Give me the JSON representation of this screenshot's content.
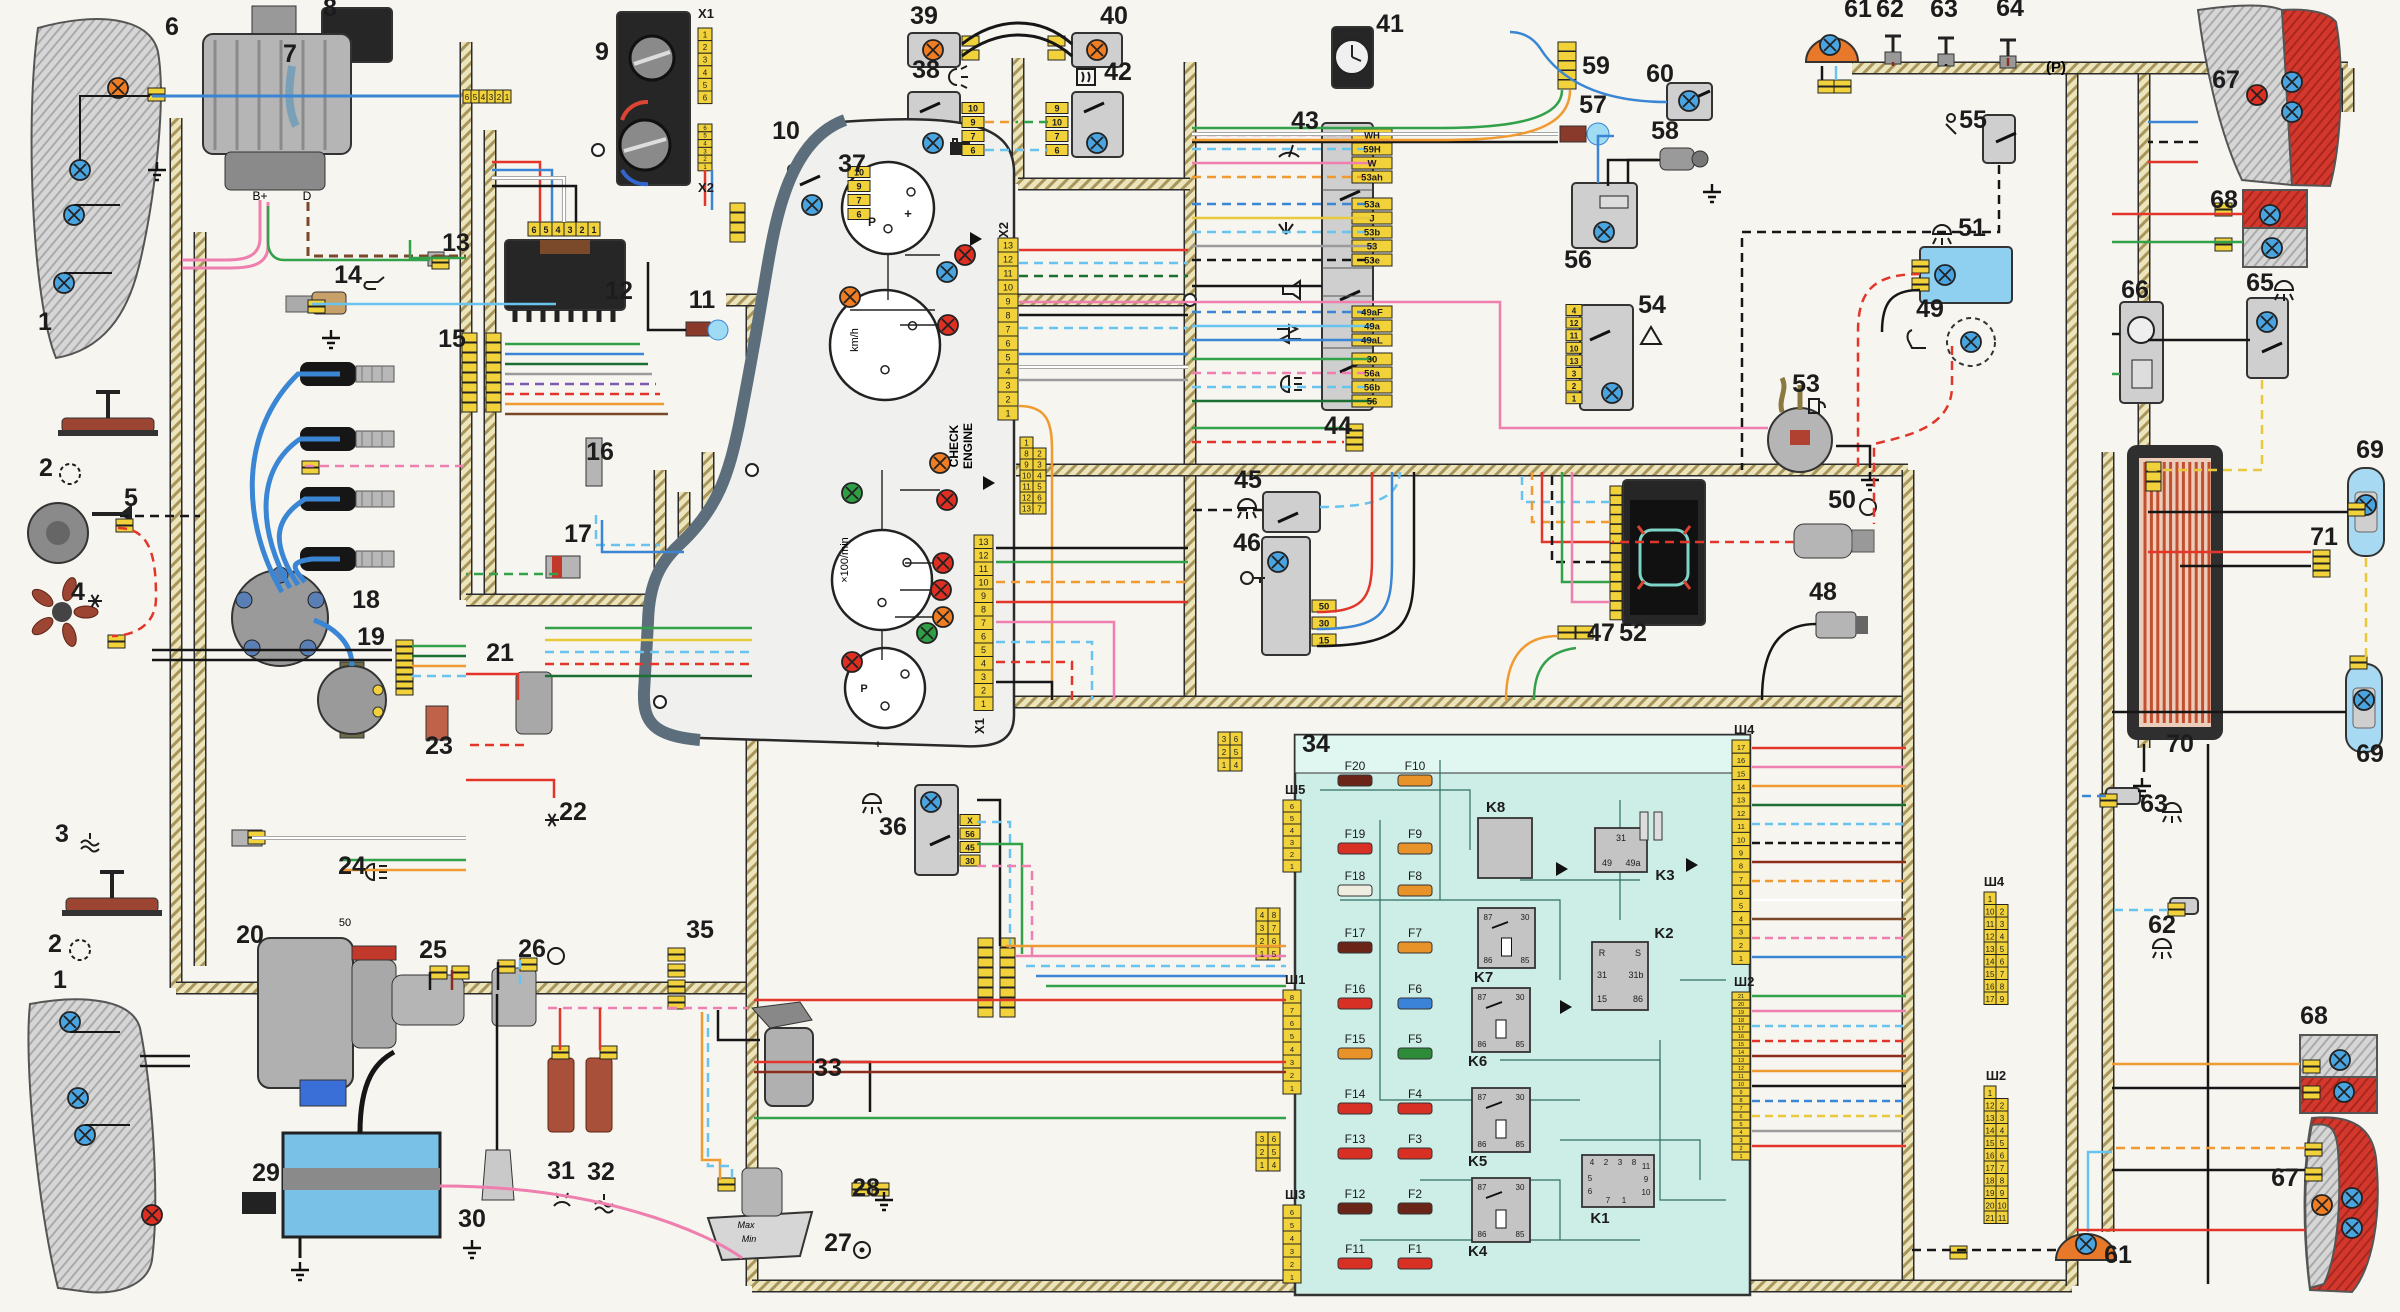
{
  "palette": {
    "paper": "#f7f5f0",
    "ink": "#1c1c1c",
    "corridor_fill": "#ece4bb",
    "corridor_hatch": "#a8955c",
    "connector_yellow": "#f2d23a",
    "component_gray": "#cfcfcf",
    "component_dark": "#262626",
    "fusebox_teal": "#cdeee6",
    "fusebox_band": "#e0f6f0",
    "fusebox_line": "#2f6e63",
    "cluster_face": "#f0f1ee",
    "cluster_bezel": "#5c6e7c",
    "battery_blue": "#7ac1e8",
    "lamp_red": "#d4372c",
    "window_heat": "#c2502e",
    "wire": {
      "red": "#e2362a",
      "dred": "#8e2c1c",
      "orange": "#ef9b31",
      "yellow": "#e8c93c",
      "green": "#33a04a",
      "dgreen": "#1c6f33",
      "blue": "#3a86d4",
      "cyan": "#68c4ee",
      "pink": "#ee7fae",
      "black": "#161616",
      "brown": "#7a4728",
      "white": "#ffffff",
      "gray": "#9b9b9b",
      "violet": "#7d5bb5"
    },
    "bulb": {
      "blue": "#4aa4e0",
      "red": "#df2f22",
      "orange": "#ee7d23",
      "green": "#2f9e44",
      "cyan": "#9fdcf4"
    }
  },
  "texts": {
    "check1": "CHECK",
    "check2": "ENGINE",
    "speed_unit": "km/h",
    "tach_scale": "×100/min",
    "alt_bplus": "B+",
    "alt_d": "D",
    "starter_term": "50",
    "res_max": "Max",
    "res_min": "Min",
    "park": "(Р)"
  },
  "components": [
    [
      "1",
      45,
      330
    ],
    [
      "1",
      60,
      988
    ],
    [
      "2",
      46,
      476
    ],
    [
      "2",
      55,
      952
    ],
    [
      "3",
      62,
      842
    ],
    [
      "4",
      78,
      600
    ],
    [
      "5",
      131,
      506
    ],
    [
      "6",
      172,
      35
    ],
    [
      "7",
      290,
      62
    ],
    [
      "8",
      330,
      16
    ],
    [
      "9",
      602,
      60
    ],
    [
      "10",
      786,
      139
    ],
    [
      "11",
      702,
      308
    ],
    [
      "12",
      619,
      299
    ],
    [
      "13",
      456,
      251
    ],
    [
      "14",
      348,
      283
    ],
    [
      "15",
      452,
      347
    ],
    [
      "16",
      600,
      460
    ],
    [
      "17",
      578,
      542
    ],
    [
      "18",
      366,
      608
    ],
    [
      "19",
      371,
      645
    ],
    [
      "20",
      250,
      943
    ],
    [
      "21",
      500,
      661
    ],
    [
      "22",
      573,
      820
    ],
    [
      "23",
      439,
      754
    ],
    [
      "24",
      352,
      874
    ],
    [
      "25",
      433,
      958
    ],
    [
      "26",
      532,
      957
    ],
    [
      "27",
      838,
      1251
    ],
    [
      "28",
      866,
      1196
    ],
    [
      "29",
      266,
      1181
    ],
    [
      "30",
      472,
      1227
    ],
    [
      "31",
      561,
      1179
    ],
    [
      "32",
      601,
      1180
    ],
    [
      "33",
      828,
      1076
    ],
    [
      "34",
      1316,
      752
    ],
    [
      "35",
      700,
      938
    ],
    [
      "36",
      893,
      835
    ],
    [
      "37",
      852,
      172
    ],
    [
      "38",
      926,
      78
    ],
    [
      "39",
      924,
      24
    ],
    [
      "40",
      1114,
      24
    ],
    [
      "41",
      1390,
      32
    ],
    [
      "42",
      1118,
      80
    ],
    [
      "43",
      1305,
      129
    ],
    [
      "44",
      1338,
      434
    ],
    [
      "45",
      1248,
      488
    ],
    [
      "46",
      1247,
      551
    ],
    [
      "47",
      1601,
      641
    ],
    [
      "48",
      1823,
      600
    ],
    [
      "49",
      1930,
      317
    ],
    [
      "50",
      1842,
      508
    ],
    [
      "51",
      1972,
      236
    ],
    [
      "52",
      1633,
      641
    ],
    [
      "53",
      1806,
      392
    ],
    [
      "54",
      1652,
      313
    ],
    [
      "55",
      1973,
      128
    ],
    [
      "56",
      1578,
      268
    ],
    [
      "57",
      1593,
      113
    ],
    [
      "58",
      1665,
      139
    ],
    [
      "59",
      1596,
      74
    ],
    [
      "60",
      1660,
      82
    ],
    [
      "61",
      1858,
      17
    ],
    [
      "62",
      1890,
      17
    ],
    [
      "63",
      1944,
      17
    ],
    [
      "64",
      2010,
      16
    ],
    [
      "61",
      2118,
      1263
    ],
    [
      "62",
      2162,
      933
    ],
    [
      "63",
      2154,
      812
    ],
    [
      "65",
      2260,
      291
    ],
    [
      "66",
      2135,
      298
    ],
    [
      "67",
      2226,
      88
    ],
    [
      "67",
      2285,
      1186
    ],
    [
      "68",
      2224,
      208
    ],
    [
      "68",
      2314,
      1024
    ],
    [
      "69",
      2370,
      458
    ],
    [
      "69",
      2370,
      762
    ],
    [
      "70",
      2180,
      752
    ],
    [
      "71",
      2324,
      545
    ]
  ],
  "misc_labels": [
    [
      "X1",
      706,
      18,
      13
    ],
    [
      "X2",
      706,
      192,
      13
    ],
    [
      "X2",
      1008,
      230,
      13,
      -90
    ],
    [
      "X1",
      984,
      726,
      13,
      -90
    ],
    [
      "+",
      908,
      218,
      13
    ],
    [
      "P",
      872,
      226,
      12
    ],
    [
      "P",
      864,
      692,
      11
    ],
    [
      "+",
      878,
      748,
      11
    ],
    [
      "Ш4",
      1994,
      886,
      13
    ],
    [
      "Ш2",
      1996,
      1080,
      13
    ]
  ],
  "cluster": {
    "x2_pins": [
      "13",
      "12",
      "11",
      "10",
      "9",
      "8",
      "7",
      "6",
      "5",
      "4",
      "3",
      "2",
      "1"
    ],
    "x1_pins": [
      "13",
      "12",
      "11",
      "10",
      "9",
      "8",
      "7",
      "6",
      "5",
      "4",
      "3",
      "2",
      "1"
    ],
    "x2_table": [
      "1",
      "8|2",
      "9|3",
      "10|4",
      "11|5",
      "12|6",
      "13|7"
    ],
    "bulbs": [
      [
        965,
        255,
        "red"
      ],
      [
        947,
        272,
        "blue"
      ],
      [
        850,
        297,
        "orange"
      ],
      [
        948,
        325,
        "red"
      ],
      [
        940,
        463,
        "orange"
      ],
      [
        852,
        493,
        "green"
      ],
      [
        947,
        500,
        "red"
      ],
      [
        943,
        563,
        "red"
      ],
      [
        941,
        590,
        "red"
      ],
      [
        943,
        617,
        "orange"
      ],
      [
        927,
        633,
        "green"
      ],
      [
        852,
        662,
        "red"
      ]
    ]
  },
  "heater9": {
    "pins_top": [
      "1",
      "2",
      "3",
      "4",
      "5",
      "6"
    ],
    "pins_bottom": [
      "6",
      "5",
      "4",
      "3",
      "2",
      "1"
    ]
  },
  "module12": {
    "pins": [
      "6",
      "5",
      "4",
      "3",
      "2",
      "1"
    ]
  },
  "strip8": {
    "pins": [
      "6",
      "5",
      "4",
      "3",
      "2",
      "1"
    ]
  },
  "switches": {
    "left_pins": [
      "10",
      "9",
      "7",
      "6"
    ],
    "right_pins": [
      "9",
      "10",
      "7",
      "6"
    ]
  },
  "ignition46": {
    "tags": [
      "50",
      "30",
      "15"
    ]
  },
  "hazard54": {
    "tags": [
      "4",
      "12",
      "11",
      "10",
      "13",
      "3",
      "2",
      "1"
    ]
  },
  "light36": {
    "tags": [
      "Х",
      "56",
      "45",
      "30"
    ]
  },
  "column43": {
    "terminals": [
      "WH",
      "59H",
      "W",
      "53ah",
      "53a",
      "J",
      "53b",
      "53",
      "53e",
      "49aF",
      "49a",
      "49aL",
      "30",
      "56a",
      "56b",
      "56"
    ]
  },
  "fusebox": {
    "fuses_left": [
      [
        "F20",
        "#6b2418"
      ],
      [
        "F19",
        "#d93025"
      ],
      [
        "F18",
        "#efece0"
      ],
      [
        "F17",
        "#6b2418"
      ],
      [
        "F16",
        "#d93025"
      ],
      [
        "F15",
        "#e8922a"
      ],
      [
        "F14",
        "#d93025"
      ],
      [
        "F13",
        "#d93025"
      ],
      [
        "F12",
        "#6b2418"
      ],
      [
        "F11",
        "#d93025"
      ]
    ],
    "fuses_right": [
      [
        "F10",
        "#e8922a"
      ],
      [
        "F9",
        "#e8922a"
      ],
      [
        "F8",
        "#e8922a"
      ],
      [
        "F7",
        "#e8922a"
      ],
      [
        "F6",
        "#3b82d9"
      ],
      [
        "F5",
        "#2e8b3a"
      ],
      [
        "F4",
        "#d93025"
      ],
      [
        "F3",
        "#d93025"
      ],
      [
        "F2",
        "#6b2418"
      ],
      [
        "F1",
        "#d93025"
      ]
    ],
    "relays": [
      "K8",
      "K7",
      "K6",
      "K5",
      "K4",
      "K3",
      "K2",
      "K1"
    ],
    "relay_pins": [
      "87",
      "30",
      "86",
      "85"
    ],
    "k3_pins": [
      "31",
      "49",
      "49a"
    ],
    "k2_pins": [
      "R",
      "S",
      "31",
      "31b",
      "15",
      "86"
    ],
    "k1_top": [
      "4",
      "2",
      "3",
      "8"
    ],
    "k1_right": [
      "11",
      "9",
      "10"
    ],
    "k1_left": [
      "5",
      "6"
    ],
    "k1_bottom": [
      "7",
      "1"
    ],
    "strips": [
      {
        "label": "Ш5",
        "pins": [
          "6",
          "5",
          "4",
          "3",
          "2",
          "1"
        ]
      },
      {
        "label": "Ш1",
        "pins": [
          "8",
          "7",
          "6",
          "5",
          "4",
          "3",
          "2",
          "1"
        ]
      },
      {
        "label": "Ш3",
        "pins": [
          "6",
          "5",
          "4",
          "3",
          "2",
          "1"
        ]
      },
      {
        "label": "Ш4",
        "pins": [
          "17",
          "16",
          "15",
          "14",
          "13",
          "12",
          "11",
          "10",
          "9",
          "8",
          "7",
          "6",
          "5",
          "4",
          "3",
          "2",
          "1"
        ]
      },
      {
        "label": "Ш2",
        "pins": [
          "21",
          "20",
          "19",
          "18",
          "17",
          "16",
          "15",
          "14",
          "13",
          "12",
          "11",
          "10",
          "9",
          "8",
          "7",
          "6",
          "5",
          "4",
          "3",
          "2",
          "1"
        ]
      }
    ],
    "mate_tables": [
      [
        "3|6",
        "2|5",
        "1|4"
      ],
      [
        "4|8",
        "3|7",
        "2|6",
        "1|5"
      ],
      [
        "3|6",
        "2|5",
        "1|4"
      ]
    ],
    "sh4_table": [
      "1",
      "10|2",
      "11|3",
      "12|4",
      "13|5",
      "14|6",
      "15|7",
      "16|8",
      "17|9"
    ],
    "sh2_table": [
      "1",
      "12|2",
      "13|3",
      "14|4",
      "15|5",
      "16|6",
      "17|7",
      "18|8",
      "19|9",
      "20|10",
      "21|11"
    ]
  }
}
